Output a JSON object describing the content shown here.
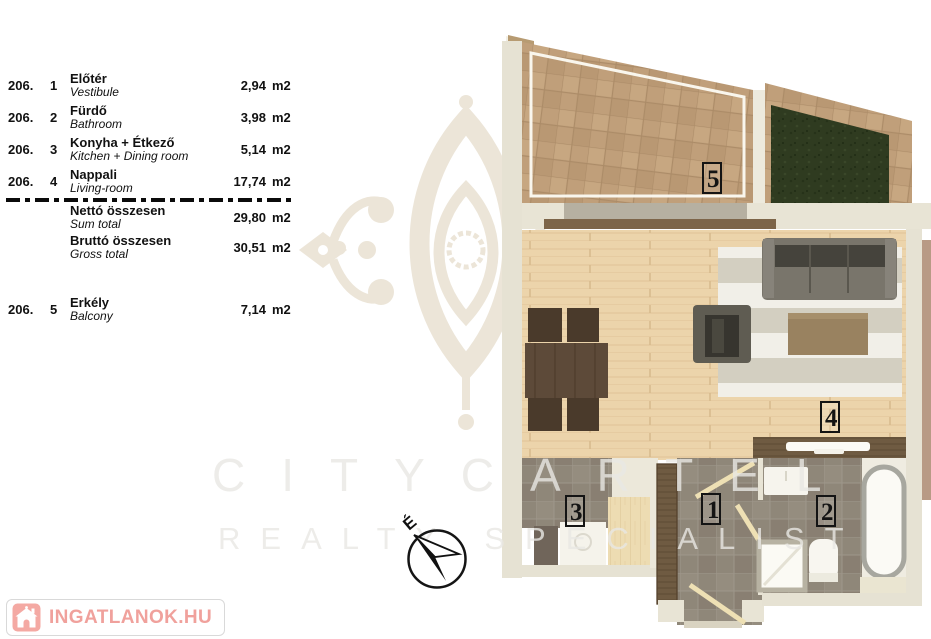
{
  "area_table": {
    "rows": [
      {
        "code": "206.",
        "num": "1",
        "name_hu": "Előtér",
        "name_en": "Vestibule",
        "value": "2,94",
        "unit": "m2"
      },
      {
        "code": "206.",
        "num": "2",
        "name_hu": "Fürdő",
        "name_en": "Bathroom",
        "value": "3,98",
        "unit": "m2"
      },
      {
        "code": "206.",
        "num": "3",
        "name_hu": "Konyha + Étkező",
        "name_en": "Kitchen + Dining room",
        "value": "5,14",
        "unit": "m2"
      },
      {
        "code": "206.",
        "num": "4",
        "name_hu": "Nappali",
        "name_en": "Living-room",
        "value": "17,74",
        "unit": "m2"
      }
    ],
    "totals": [
      {
        "name_hu": "Nettó összesen",
        "name_en": "Sum total",
        "value": "29,80",
        "unit": "m2"
      },
      {
        "name_hu": "Bruttó összesen",
        "name_en": "Gross total",
        "value": "30,51",
        "unit": "m2"
      }
    ],
    "balcony_row": {
      "code": "206.",
      "num": "5",
      "name_hu": "Erkély",
      "name_en": "Balcony",
      "value": "7,14",
      "unit": "m2"
    }
  },
  "floorplan": {
    "room_labels": [
      {
        "room": "vestibule",
        "label": "1"
      },
      {
        "room": "bathroom",
        "label": "2"
      },
      {
        "room": "kitchen",
        "label": "3"
      },
      {
        "room": "living-room",
        "label": "4"
      },
      {
        "room": "balcony",
        "label": "5"
      }
    ]
  },
  "compass": {
    "north_label": "É"
  },
  "watermark": {
    "brand": "CITYCARTEL",
    "tagline": "REALTY SPECIALIST"
  },
  "footer": {
    "logo_text": "INGATLANOK.HU"
  },
  "colors": {
    "accent_pink": "#f0a19c",
    "wall_cream": "#e6e2d3",
    "terrace_tile": "#c09f7a",
    "grass_green": "#2f3b20",
    "wood_floor": "#ecd4ab",
    "gray_tile": "#8f8779",
    "ink": "#111111"
  }
}
